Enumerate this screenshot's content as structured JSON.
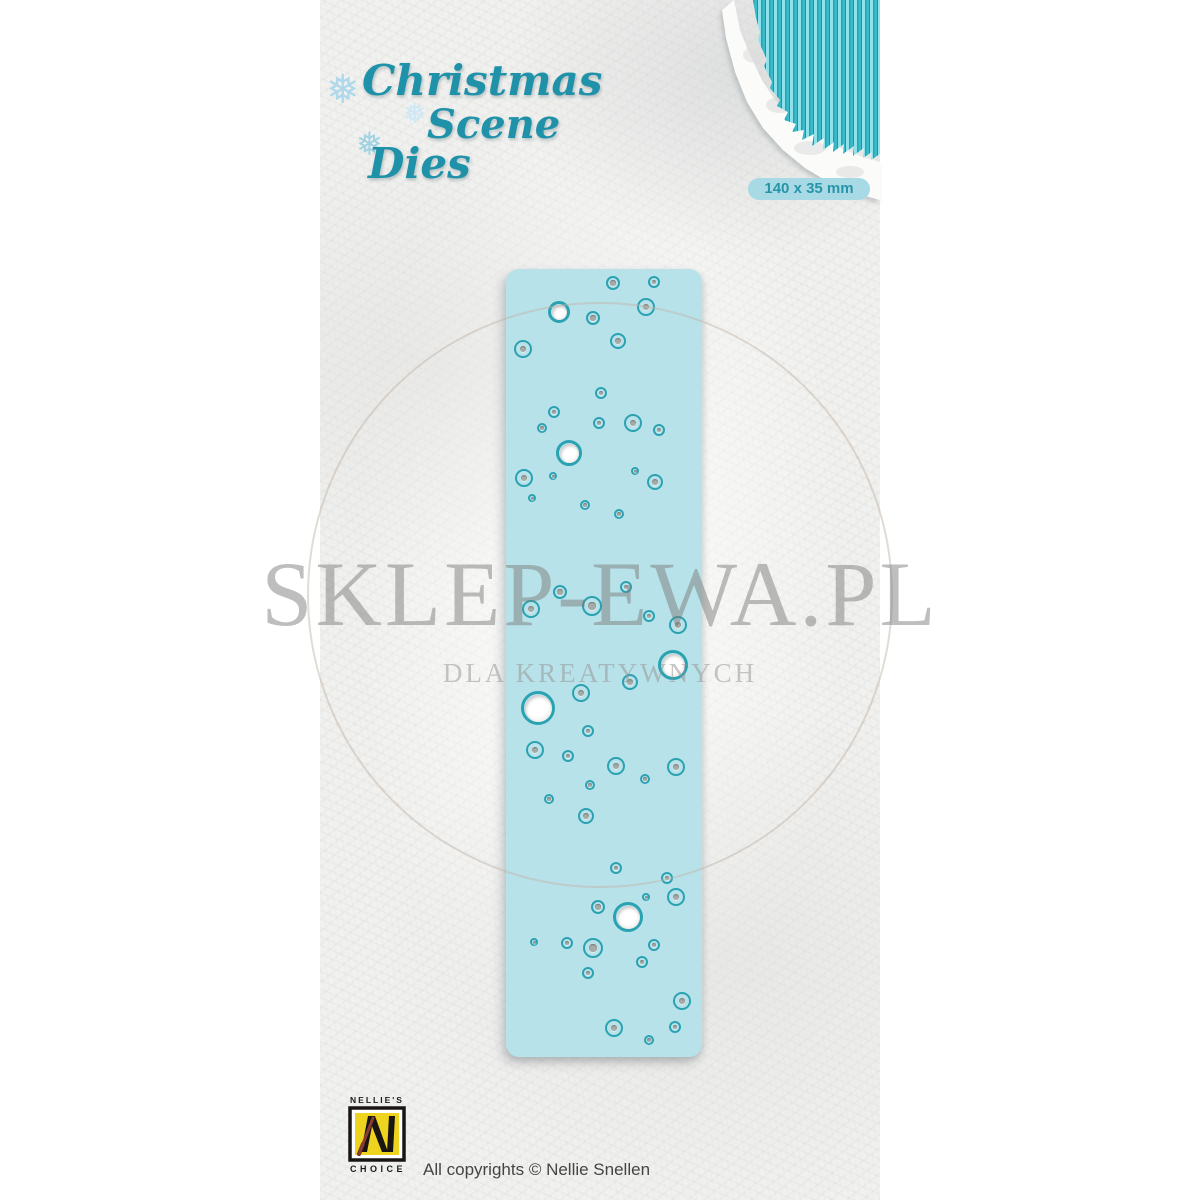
{
  "logo": {
    "line1": "Christmas",
    "line2": "Scene",
    "line3": "Dies"
  },
  "icons": {
    "snowflake": "❅"
  },
  "size_badge": {
    "label": "140 x 35 mm"
  },
  "watermark": {
    "title": "SKLEP-EWA.PL",
    "subtitle": "DLA KREATYWNYCH"
  },
  "footer": {
    "brand_top": "NELLIE'S",
    "brand_bottom": "CHOICE",
    "copyright": "All copyrights © Nellie Snellen"
  },
  "colors": {
    "brand-teal": "#1f91a8",
    "badge-bg": "#a8dae5",
    "badge-text": "#2795a8",
    "die-fill": "#b8e2e9",
    "die-ring": "#2aa2b2",
    "die-dot": "#a6aaa7",
    "stripe-light": "#8de2ec",
    "stripe-mid": "#3ab9c8",
    "stripe-dark": "#1a8a9b",
    "logo-yellow": "#eed31f",
    "logo-black": "#181512",
    "brush-red": "#8a3c34",
    "copyright-gray": "#454545"
  },
  "die": {
    "circles": [
      [
        613,
        283,
        7,
        "dot"
      ],
      [
        654,
        282,
        6,
        "dot"
      ],
      [
        559,
        312,
        11,
        "hole"
      ],
      [
        593,
        318,
        7,
        "dot"
      ],
      [
        646,
        307,
        9,
        "dot"
      ],
      [
        523,
        349,
        9,
        "dot"
      ],
      [
        618,
        341,
        8,
        "dot"
      ],
      [
        601,
        393,
        6,
        "dot"
      ],
      [
        554,
        412,
        6,
        "dot"
      ],
      [
        542,
        428,
        5,
        "dot"
      ],
      [
        599,
        423,
        6,
        "dot"
      ],
      [
        633,
        423,
        9,
        "dot"
      ],
      [
        659,
        430,
        6,
        "dot"
      ],
      [
        569,
        453,
        13,
        "hole"
      ],
      [
        524,
        478,
        9,
        "dot"
      ],
      [
        553,
        476,
        4,
        "dot"
      ],
      [
        635,
        471,
        4,
        "dot"
      ],
      [
        655,
        482,
        8,
        "dot"
      ],
      [
        532,
        498,
        4,
        "dot"
      ],
      [
        585,
        505,
        5,
        "dot"
      ],
      [
        619,
        514,
        5,
        "dot"
      ],
      [
        560,
        592,
        7,
        "dot"
      ],
      [
        626,
        587,
        6,
        "dot"
      ],
      [
        531,
        609,
        9,
        "dot"
      ],
      [
        592,
        606,
        10,
        "dot"
      ],
      [
        649,
        616,
        6,
        "dot"
      ],
      [
        678,
        625,
        9,
        "dot"
      ],
      [
        673,
        665,
        15,
        "hole"
      ],
      [
        630,
        682,
        8,
        "dot"
      ],
      [
        581,
        693,
        9,
        "dot"
      ],
      [
        538,
        708,
        17,
        "hole"
      ],
      [
        588,
        731,
        6,
        "dot"
      ],
      [
        535,
        750,
        9,
        "dot"
      ],
      [
        568,
        756,
        6,
        "dot"
      ],
      [
        616,
        766,
        9,
        "dot"
      ],
      [
        676,
        767,
        9,
        "dot"
      ],
      [
        645,
        779,
        5,
        "dot"
      ],
      [
        590,
        785,
        5,
        "dot"
      ],
      [
        549,
        799,
        5,
        "dot"
      ],
      [
        586,
        816,
        8,
        "dot"
      ],
      [
        616,
        868,
        6,
        "dot"
      ],
      [
        667,
        878,
        6,
        "dot"
      ],
      [
        646,
        897,
        4,
        "dot"
      ],
      [
        676,
        897,
        9,
        "dot"
      ],
      [
        598,
        907,
        7,
        "dot"
      ],
      [
        628,
        917,
        15,
        "hole"
      ],
      [
        534,
        942,
        4,
        "dot"
      ],
      [
        567,
        943,
        6,
        "dot"
      ],
      [
        593,
        948,
        10,
        "dot"
      ],
      [
        654,
        945,
        6,
        "dot"
      ],
      [
        642,
        962,
        6,
        "dot"
      ],
      [
        588,
        973,
        6,
        "dot"
      ],
      [
        682,
        1001,
        9,
        "dot"
      ],
      [
        614,
        1028,
        9,
        "dot"
      ],
      [
        675,
        1027,
        6,
        "dot"
      ],
      [
        649,
        1040,
        5,
        "dot"
      ]
    ]
  }
}
